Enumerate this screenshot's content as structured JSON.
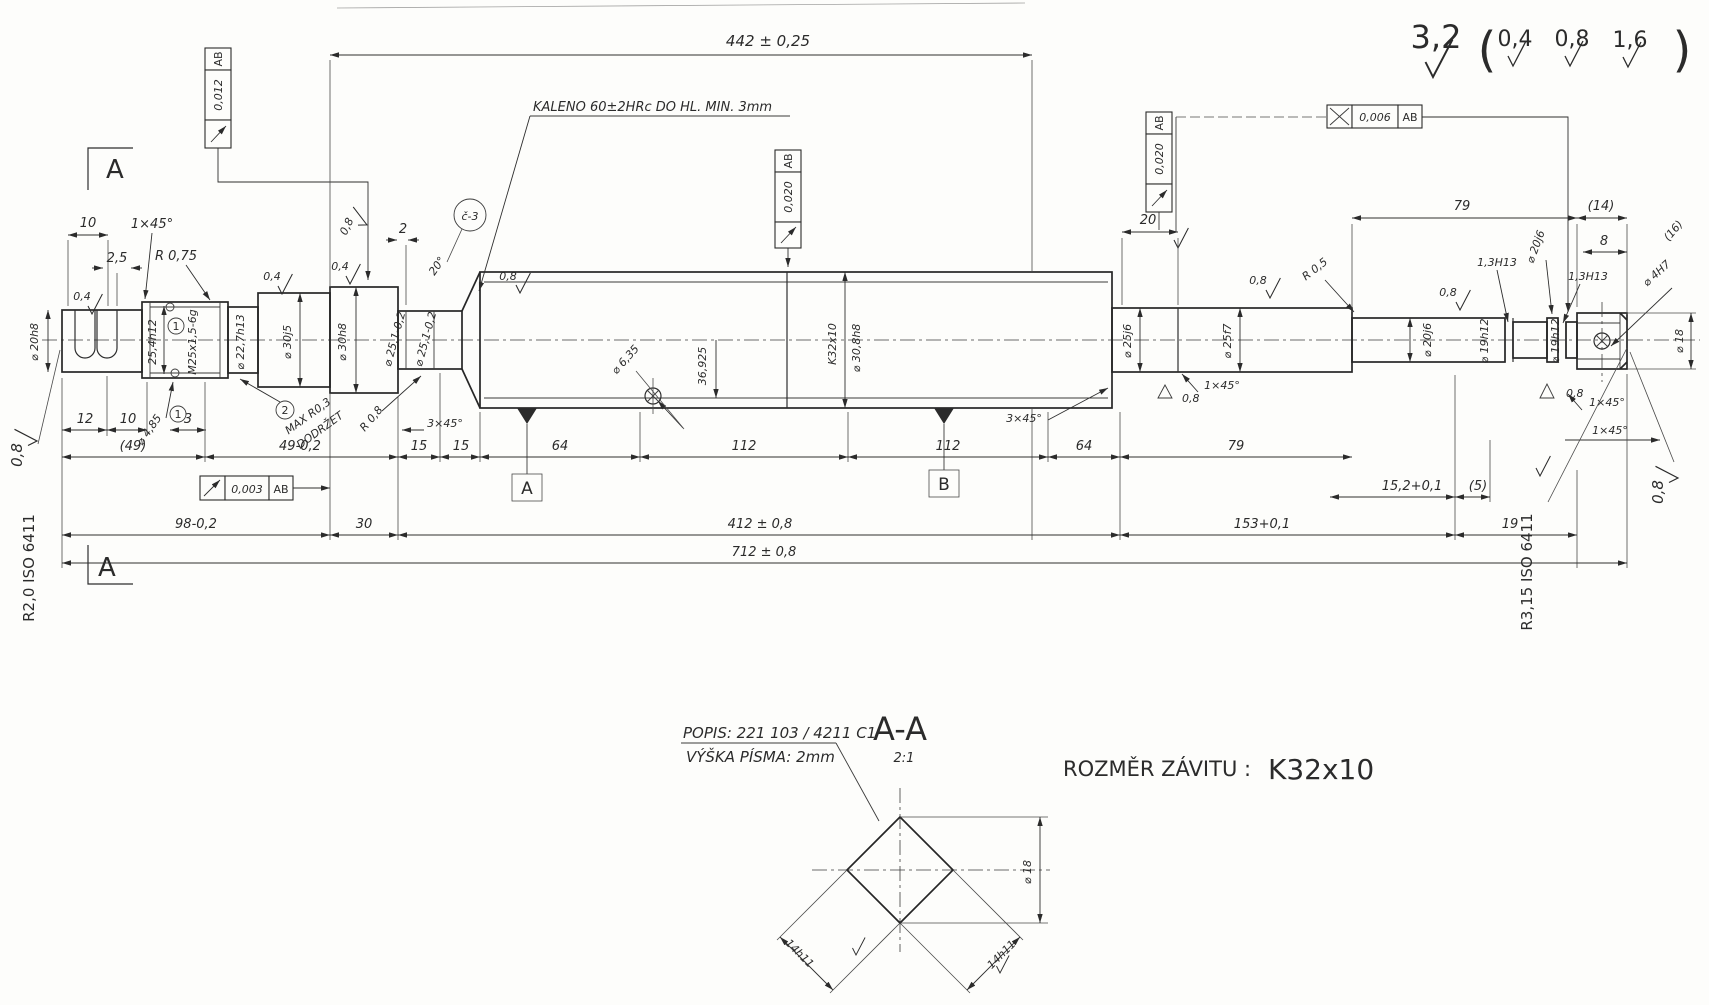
{
  "title": "Shaft manufacturing drawing (Czech, ČSN style)",
  "surface_finish": {
    "main": "3,2",
    "alt1": "0,4",
    "alt2": "0,8",
    "alt3": "1,6",
    "paren_l": "(",
    "paren_r": ")"
  },
  "notes": {
    "kaleno": "KALENO 60±2HRc DO HL. MIN. 3mm",
    "maxr": "MAX R0,3",
    "dodrzet": "DODRŽET",
    "popis": "POPIS: 221 103 / 4211 C1",
    "vyska": "VÝŠKA PÍSMA: 2mm",
    "rozmer_label": "ROZMĚR ZÁVITU :",
    "rozmer_value": "K32x10"
  },
  "fcf": {
    "runout_012": "0,012",
    "runout_020": "0,020",
    "x_006": "0,006",
    "runout_003": "0,003",
    "datum_ab": "AB"
  },
  "datums": {
    "a": "A",
    "b": "B"
  },
  "section": {
    "mark": "A",
    "title": "A-A",
    "scale": "2:1",
    "flat": "14h11",
    "dia": "⌀ 18"
  },
  "iso": {
    "left": "R2,0 ISO 6411",
    "right": "R3,15 ISO 6411"
  },
  "balloons": {
    "n1": "1",
    "n2": "2",
    "c3": "č-3"
  },
  "labels": {
    "d442": "442 ± 0,25",
    "d10": "10",
    "d25": "2,5",
    "c1x45": "1×45°",
    "r075": "R 0,75",
    "d20h8": "⌀ 20h8",
    "d254h12": "25,4h12",
    "m25": "M25x1,5-6g",
    "d227h13": "⌀ 22,7h13",
    "d30j5": "⌀ 30j5",
    "d30h8": "⌀ 30h8",
    "d251": "⌀ 25,1-0,2",
    "d485": "⌀ 4,85",
    "v04": "0,4",
    "v08": "0,8",
    "d2": "2",
    "a20": "20°",
    "r08": "R 0,8",
    "c3x45": "3×45°",
    "d635": "⌀ 6,35",
    "d36925": "36,925",
    "k32": "K32x10",
    "d308h8": "⌀ 30,8h8",
    "d12": "12",
    "d3": "3",
    "p49": "(49)",
    "d49": "49-0,2",
    "d15": "15",
    "d64": "64",
    "d112": "112",
    "d79": "79",
    "d20": "20",
    "d25j6": "⌀ 25j6",
    "d25f7": "⌀ 25f7",
    "r05": "R 0,5",
    "d20j6": "⌀ 20j6",
    "d19h12": "⌀ 19h12",
    "d13h13": "1,3H13",
    "d8": "8",
    "d4h7": "⌀ 4H7",
    "p14": "(14)",
    "p16": "(16)",
    "d18": "⌀ 18",
    "d152": "15,2+0,1",
    "p5": "(5)",
    "d19": "19",
    "d98": "98-0,2",
    "d30": "30",
    "d412": "412 ± 0,8",
    "d153": "153+0,1",
    "d712": "712 ± 0,8"
  }
}
